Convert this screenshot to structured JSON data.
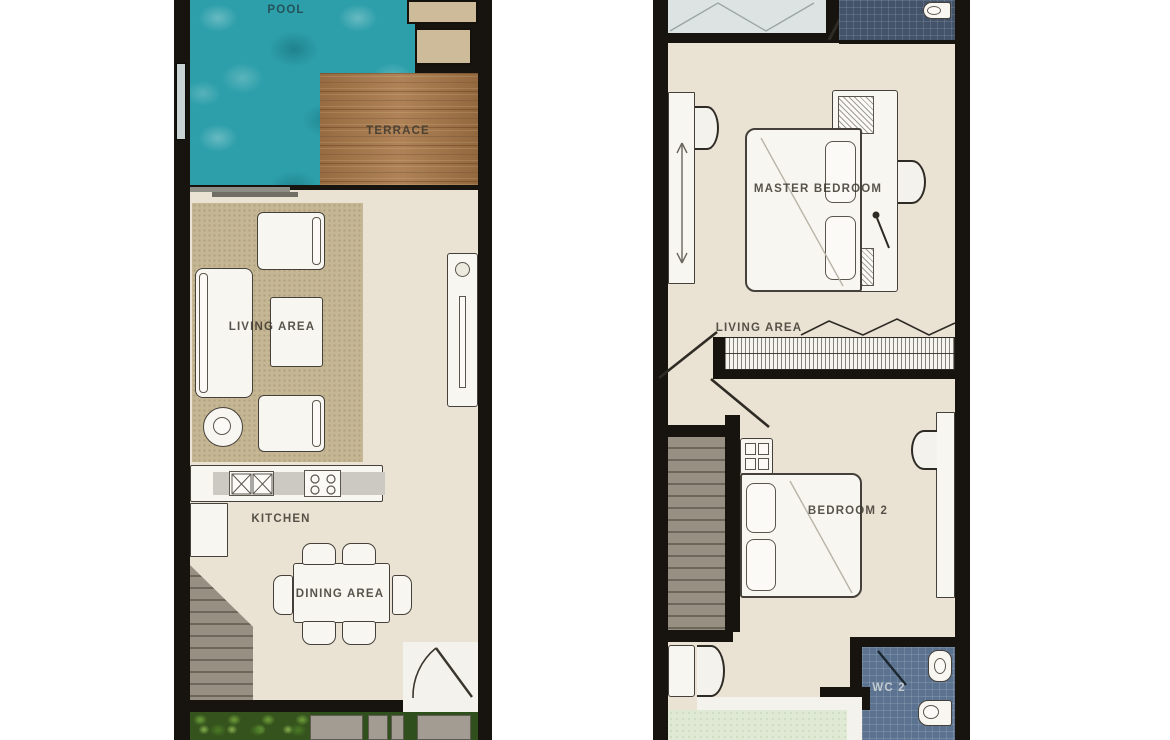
{
  "plans": {
    "ground": {
      "pool_label": "POOL",
      "terrace_label": "TERRACE",
      "living_area_label": "LIVING AREA",
      "kitchen_label": "KITCHEN",
      "dining_area_label": "DINING AREA"
    },
    "upper": {
      "master_bedroom_label": "MASTER BEDROOM",
      "living_area_label": "LIVING AREA",
      "bedroom_2_label": "BEDROOM 2",
      "wc_2_label": "WC 2"
    }
  },
  "colors": {
    "pool_water": "#2d9faa",
    "terrace_wood": "#a6794c",
    "interior_floor": "#eae3d4",
    "living_rug": "#c5b694",
    "wall": "#17130e",
    "stair_gray": "#8f887c",
    "bathroom_tile_dark": "#42536a",
    "wc_tile_blue": "#5b7390",
    "closet_tile_light": "#dde3e2",
    "garden_green": "#2f4f1c",
    "stepping_stone": "#a29c92",
    "balcony_green": "#dfe9d3",
    "furniture_white": "#f8f6f0"
  }
}
